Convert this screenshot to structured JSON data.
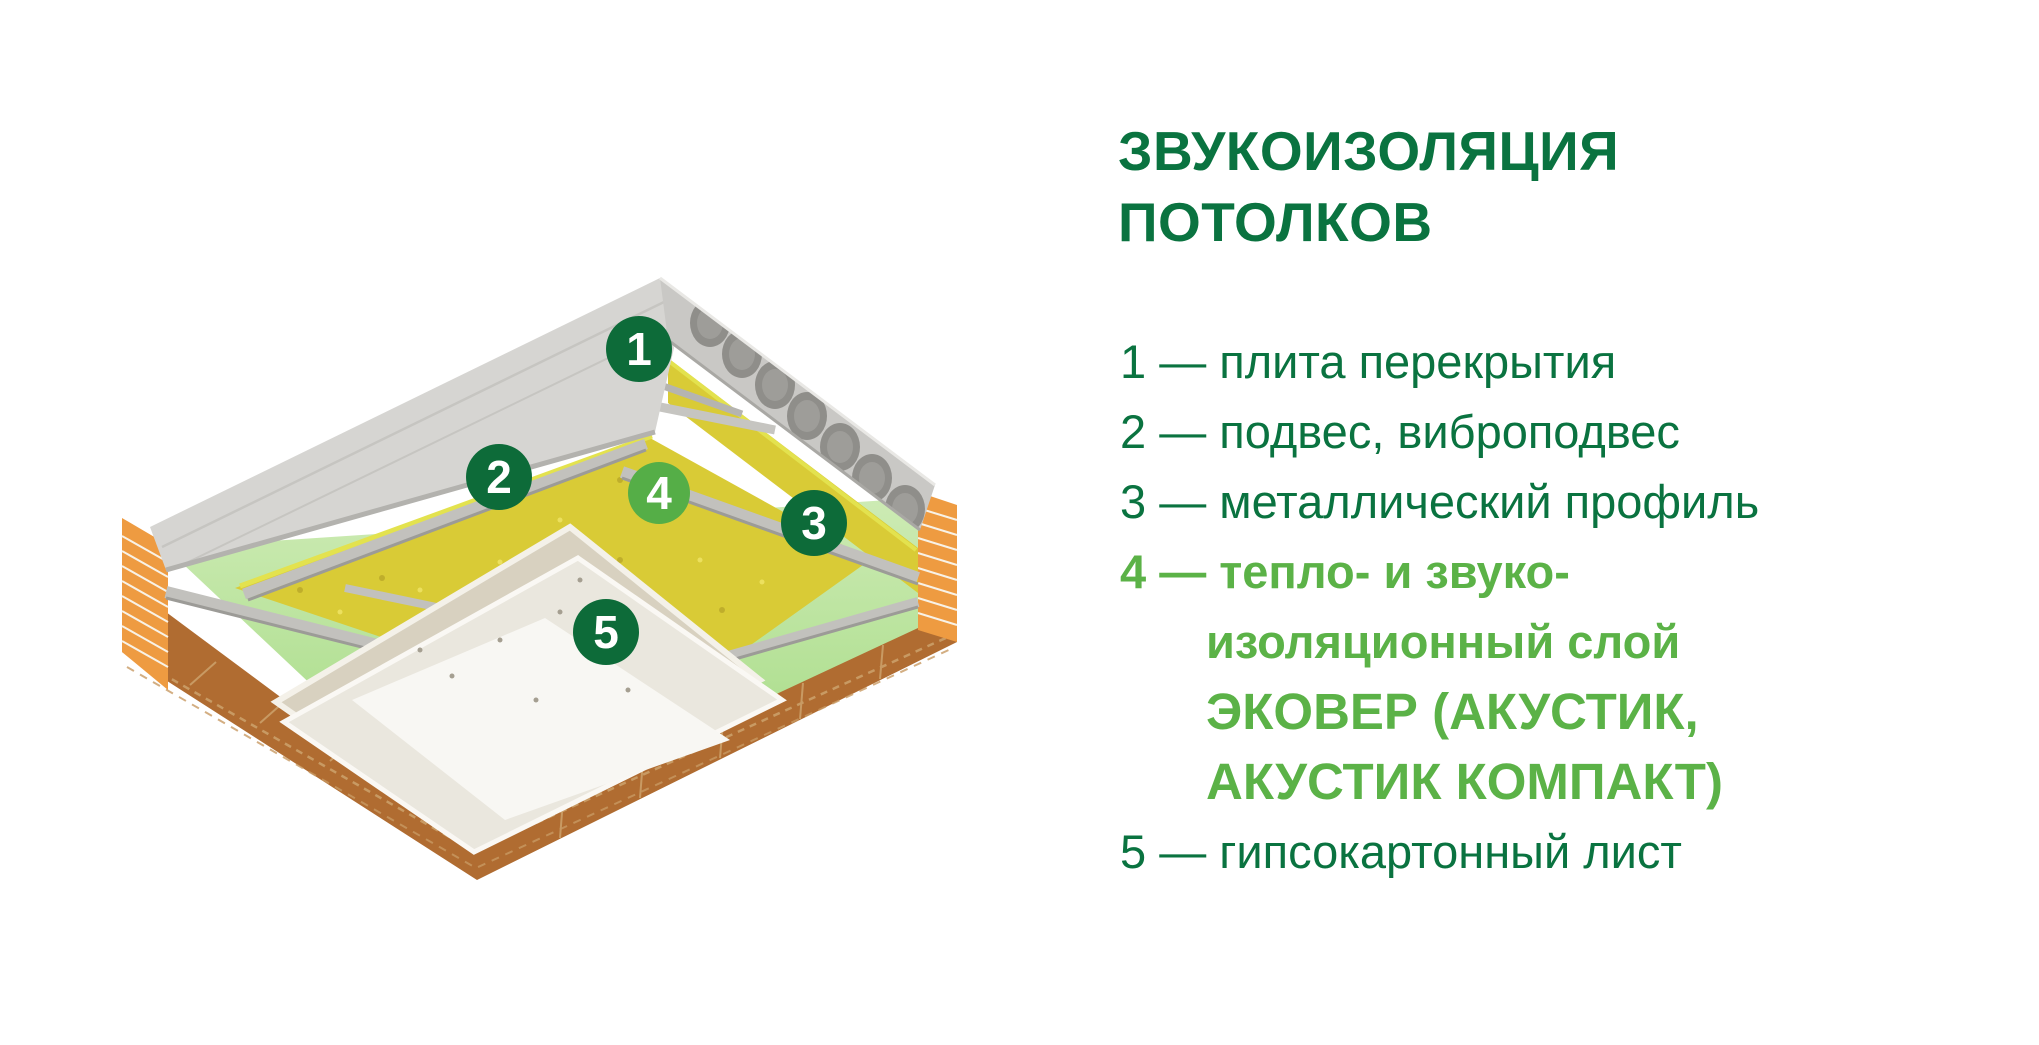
{
  "title": {
    "line1": "ЗВУКОИЗОЛЯЦИЯ",
    "line2": "ПОТОЛКОВ"
  },
  "legend": {
    "rows": [
      {
        "text": "1 — плита перекрытия"
      },
      {
        "text": "2 — подвес, виброподвес"
      },
      {
        "text": "3 — металлический профиль"
      },
      {
        "text": "4 — тепло- и звуко-"
      },
      {
        "text": "изоляционный слой"
      },
      {
        "text": "ЭКОВЕР (АКУСТИК,"
      },
      {
        "text": "АКУСТИК КОМПАКТ)"
      },
      {
        "text": "5 — гипсокартонный лист"
      }
    ]
  },
  "diagram": {
    "description": "3D cutaway of ceiling sound insulation: hollow-core concrete slab, hangers, metal profiles, mineral wool layer, gypsum boards, brick walls",
    "markers": [
      {
        "label": "1"
      },
      {
        "label": "2"
      },
      {
        "label": "3"
      },
      {
        "label": "4"
      },
      {
        "label": "5"
      }
    ]
  },
  "colors": {
    "green_dark": "#0a7340",
    "green_light": "#5bb247",
    "marker_dark": "#0d6b39",
    "marker_light": "#55ae47",
    "concrete": "#d6d5d2",
    "concrete_side": "#c9c8c5",
    "hole": "#8f8e8a",
    "brick": "#ee9b41",
    "brick_dark": "#b06c31",
    "mortar": "#f8f2e6",
    "wool": "#d9cb36",
    "wool_light": "#e3e24e",
    "metal": "#c2c1bd",
    "paint_top": "#cdebb4",
    "paint_bottom": "#9ed87c",
    "board_top": "#d8d1c0",
    "board_mid": "#eae7de",
    "board_bottom": "#f8f7f3",
    "page_bg": "#ffffff"
  }
}
